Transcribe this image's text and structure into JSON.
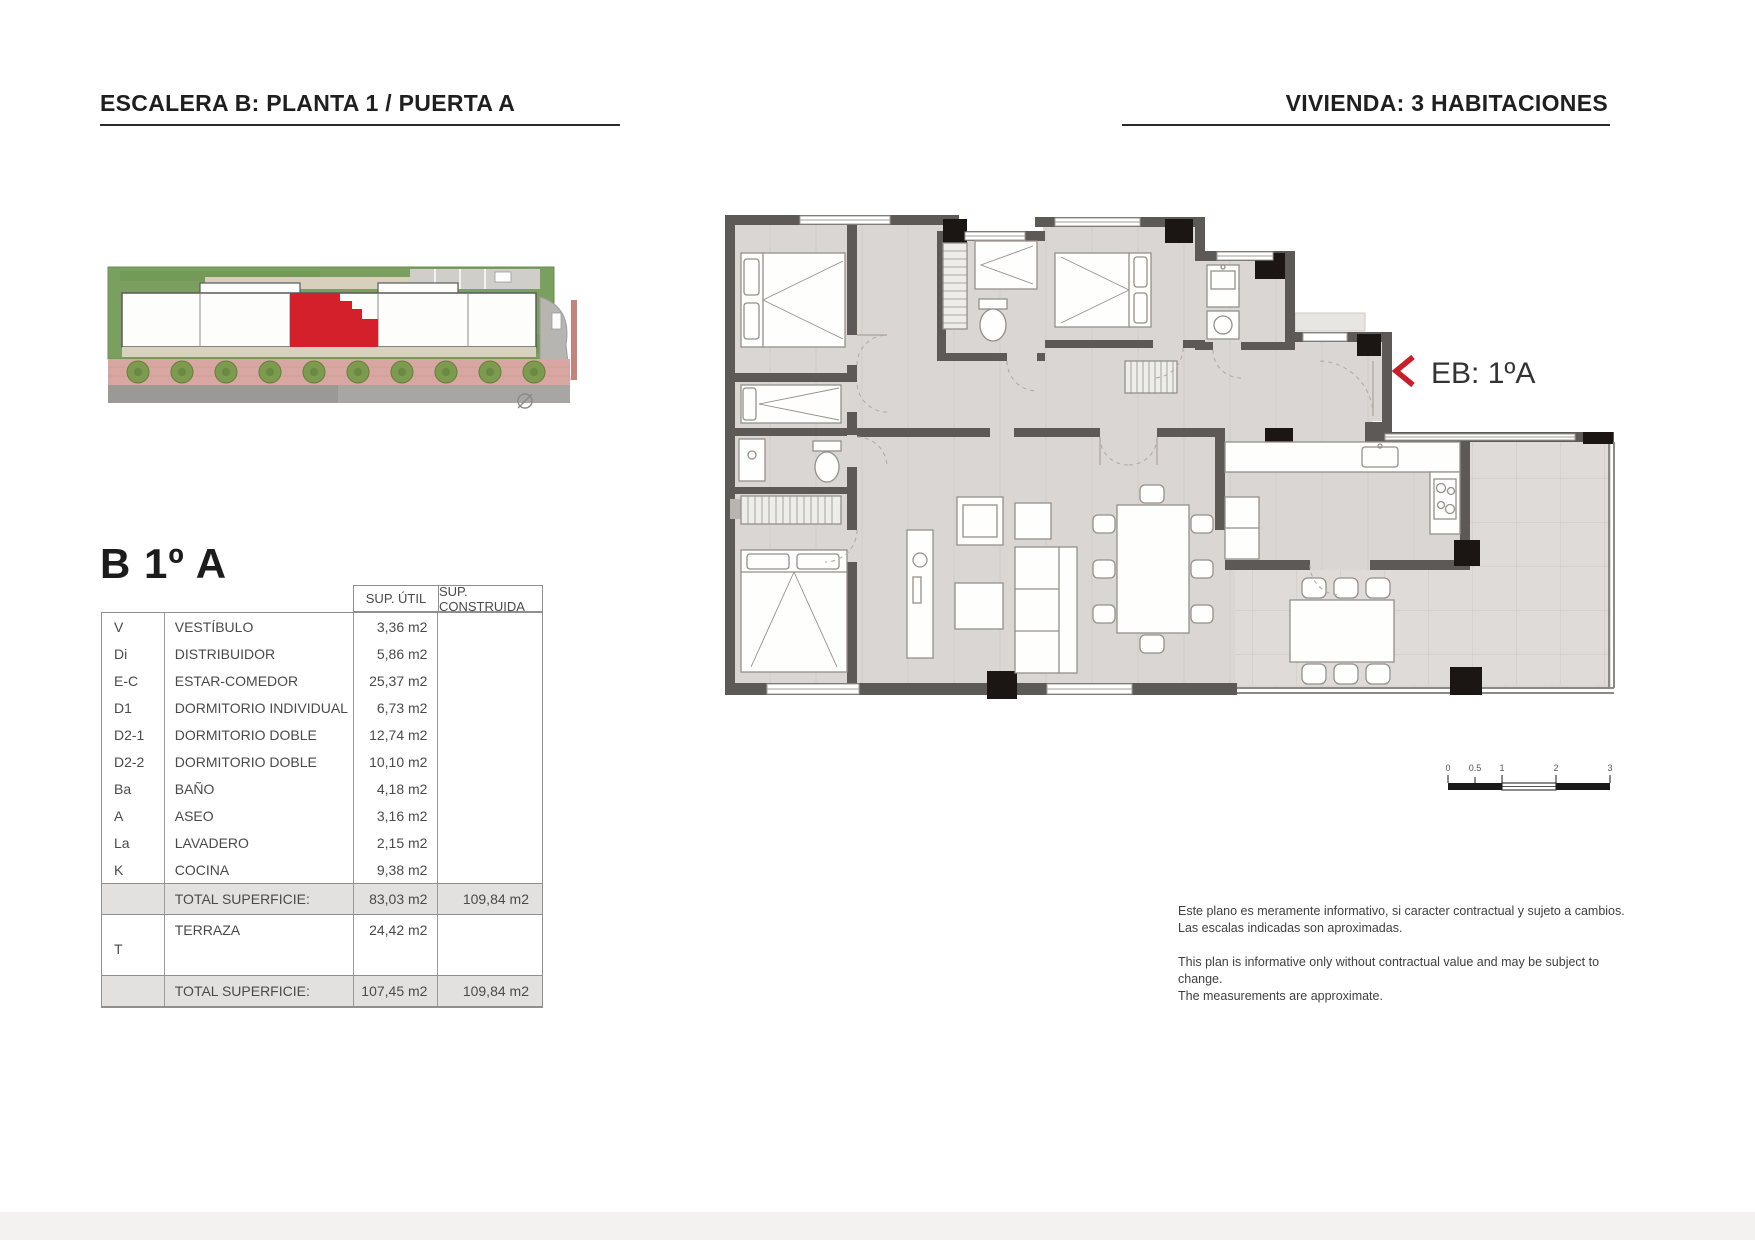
{
  "header": {
    "title_left": "ESCALERA B: PLANTA 1 / PUERTA A",
    "title_right": "VIVIENDA: 3 HABITACIONES"
  },
  "unit": {
    "name": "B 1º A",
    "entrance_label": "EB: 1ºA"
  },
  "table": {
    "headers": {
      "util": "SUP. ÚTIL",
      "construida": "SUP. CONSTRUIDA"
    },
    "rows": [
      {
        "code": "V",
        "name": "VESTÍBULO",
        "util": "3,36 m2",
        "construida": ""
      },
      {
        "code": "Di",
        "name": "DISTRIBUIDOR",
        "util": "5,86 m2",
        "construida": ""
      },
      {
        "code": "E-C",
        "name": "ESTAR-COMEDOR",
        "util": "25,37 m2",
        "construida": ""
      },
      {
        "code": "D1",
        "name": "DORMITORIO INDIVIDUAL",
        "util": "6,73 m2",
        "construida": ""
      },
      {
        "code": "D2-1",
        "name": "DORMITORIO DOBLE",
        "util": "12,74 m2",
        "construida": ""
      },
      {
        "code": "D2-2",
        "name": "DORMITORIO DOBLE",
        "util": "10,10 m2",
        "construida": ""
      },
      {
        "code": "Ba",
        "name": "BAÑO",
        "util": "4,18 m2",
        "construida": ""
      },
      {
        "code": "A",
        "name": "ASEO",
        "util": "3,16 m2",
        "construida": ""
      },
      {
        "code": "La",
        "name": "LAVADERO",
        "util": "2,15 m2",
        "construida": ""
      },
      {
        "code": "K",
        "name": "COCINA",
        "util": "9,38 m2",
        "construida": ""
      }
    ],
    "total_interior": {
      "label": "TOTAL SUPERFICIE:",
      "util": "83,03 m2",
      "construida": "109,84 m2"
    },
    "terrace": {
      "code": "T",
      "name": "TERRAZA",
      "util": "24,42 m2",
      "construida": ""
    },
    "total_with_terrace": {
      "label": "TOTAL SUPERFICIE:",
      "util": "107,45 m2",
      "construida": "109,84 m2"
    }
  },
  "scalebar": {
    "labels": [
      "0",
      "0.5",
      "1",
      "2",
      "3"
    ]
  },
  "disclaimer": {
    "es1": "Este plano es meramente informativo, si caracter contractual y sujeto a cambios.",
    "es2": "Las escalas indicadas son aproximadas.",
    "en1": "This plan is informative only without contractual value and may be subject to change.",
    "en2": "The measurements are approximate."
  },
  "colors": {
    "wall": "#5d5956",
    "floor": "#d9d6d3",
    "terrace_floor": "#dedbd8",
    "column": "#1b1613",
    "accent_red": "#c8202a",
    "total_row_bg": "#e2e1e0",
    "site_lawn": "#7b9f5e",
    "site_unit_red": "#d3202b",
    "site_sidewalk": "#d8a7a1"
  }
}
